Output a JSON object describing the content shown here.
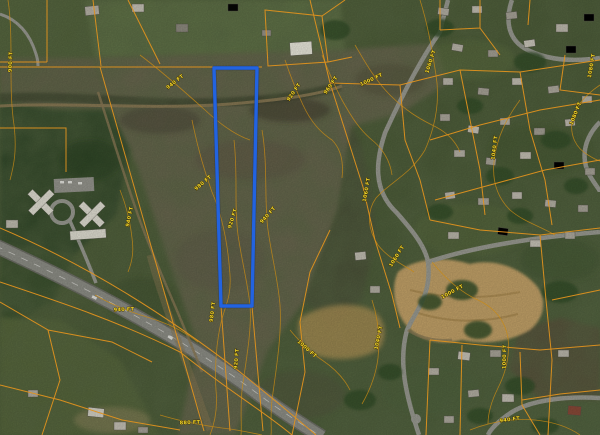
{
  "map": {
    "view": "aerial-satellite-imagery",
    "overlays": [
      "parcel-boundaries",
      "elevation-contours",
      "selected-parcel-highlight"
    ],
    "elevation_unit": "FT"
  },
  "colors": {
    "parcel_line": "#e0921e",
    "contour_line": "#c98a14",
    "contour_label": "#f2d62a",
    "selected_parcel": "#2263e0"
  },
  "selected_parcel": {
    "points": "214,68 257,68 252,306 221,306",
    "stroke_width": 3.4
  },
  "contour_labels": [
    {
      "text": "900 FT",
      "x": 12,
      "y": 62,
      "angle": -88
    },
    {
      "text": "940 FT",
      "x": 176,
      "y": 83,
      "angle": -38
    },
    {
      "text": "920 FT",
      "x": 295,
      "y": 93,
      "angle": -55
    },
    {
      "text": "960 FT",
      "x": 332,
      "y": 86,
      "angle": -55
    },
    {
      "text": "1000 FT",
      "x": 372,
      "y": 81,
      "angle": -25
    },
    {
      "text": "1060 FT",
      "x": 432,
      "y": 62,
      "angle": -72
    },
    {
      "text": "1080 FT",
      "x": 577,
      "y": 114,
      "angle": -68
    },
    {
      "text": "1080 FT",
      "x": 593,
      "y": 66,
      "angle": -80
    },
    {
      "text": "1040 FT",
      "x": 496,
      "y": 148,
      "angle": -82
    },
    {
      "text": "1060 FT",
      "x": 368,
      "y": 190,
      "angle": -80
    },
    {
      "text": "980 FT",
      "x": 204,
      "y": 184,
      "angle": -40
    },
    {
      "text": "920 FT",
      "x": 234,
      "y": 219,
      "angle": -72
    },
    {
      "text": "940 FT",
      "x": 269,
      "y": 216,
      "angle": -48
    },
    {
      "text": "940 FT",
      "x": 131,
      "y": 217,
      "angle": -78
    },
    {
      "text": "940 FT",
      "x": 124,
      "y": 311,
      "angle": -2
    },
    {
      "text": "980 FT",
      "x": 214,
      "y": 312,
      "angle": -82
    },
    {
      "text": "920 FT",
      "x": 238,
      "y": 359,
      "angle": -85
    },
    {
      "text": "880 FT",
      "x": 190,
      "y": 424,
      "angle": -2
    },
    {
      "text": "1060 FT",
      "x": 398,
      "y": 257,
      "angle": -58
    },
    {
      "text": "1000 FT",
      "x": 453,
      "y": 293,
      "angle": -28
    },
    {
      "text": "1040 FT",
      "x": 380,
      "y": 338,
      "angle": -78
    },
    {
      "text": "1000 FT",
      "x": 506,
      "y": 357,
      "angle": -88
    },
    {
      "text": "940 FT",
      "x": 510,
      "y": 421,
      "angle": -8
    },
    {
      "text": "1000 FT",
      "x": 306,
      "y": 350,
      "angle": 42
    }
  ]
}
